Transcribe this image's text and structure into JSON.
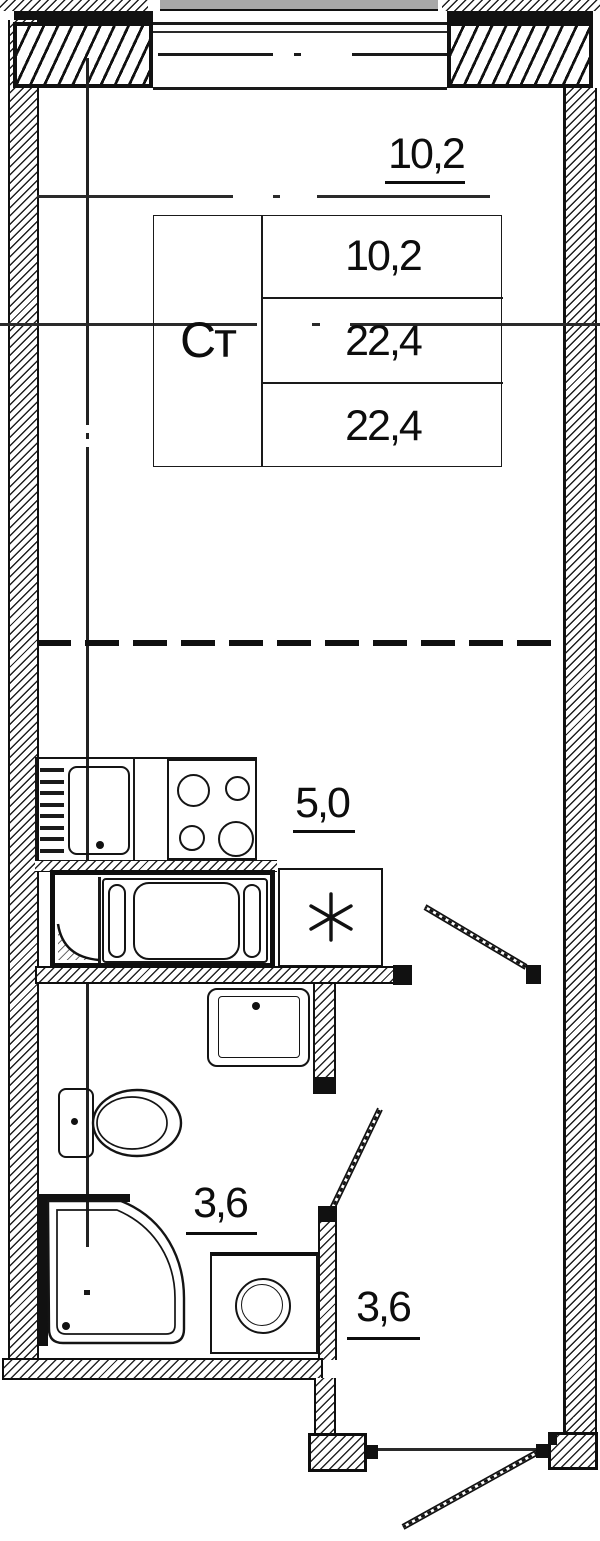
{
  "plan": {
    "unit_table": {
      "label": "Ст",
      "rows": [
        "10,2",
        "22,4",
        "22,4"
      ]
    },
    "areas": {
      "living": "10,2",
      "kitchen": "5,0",
      "bathroom": "3,6",
      "hallway": "3,6"
    },
    "fridge_marker": "*"
  },
  "colors": {
    "ink": "#111111",
    "background": "#ffffff",
    "cut_structure_gray": "#a8a8a8"
  }
}
